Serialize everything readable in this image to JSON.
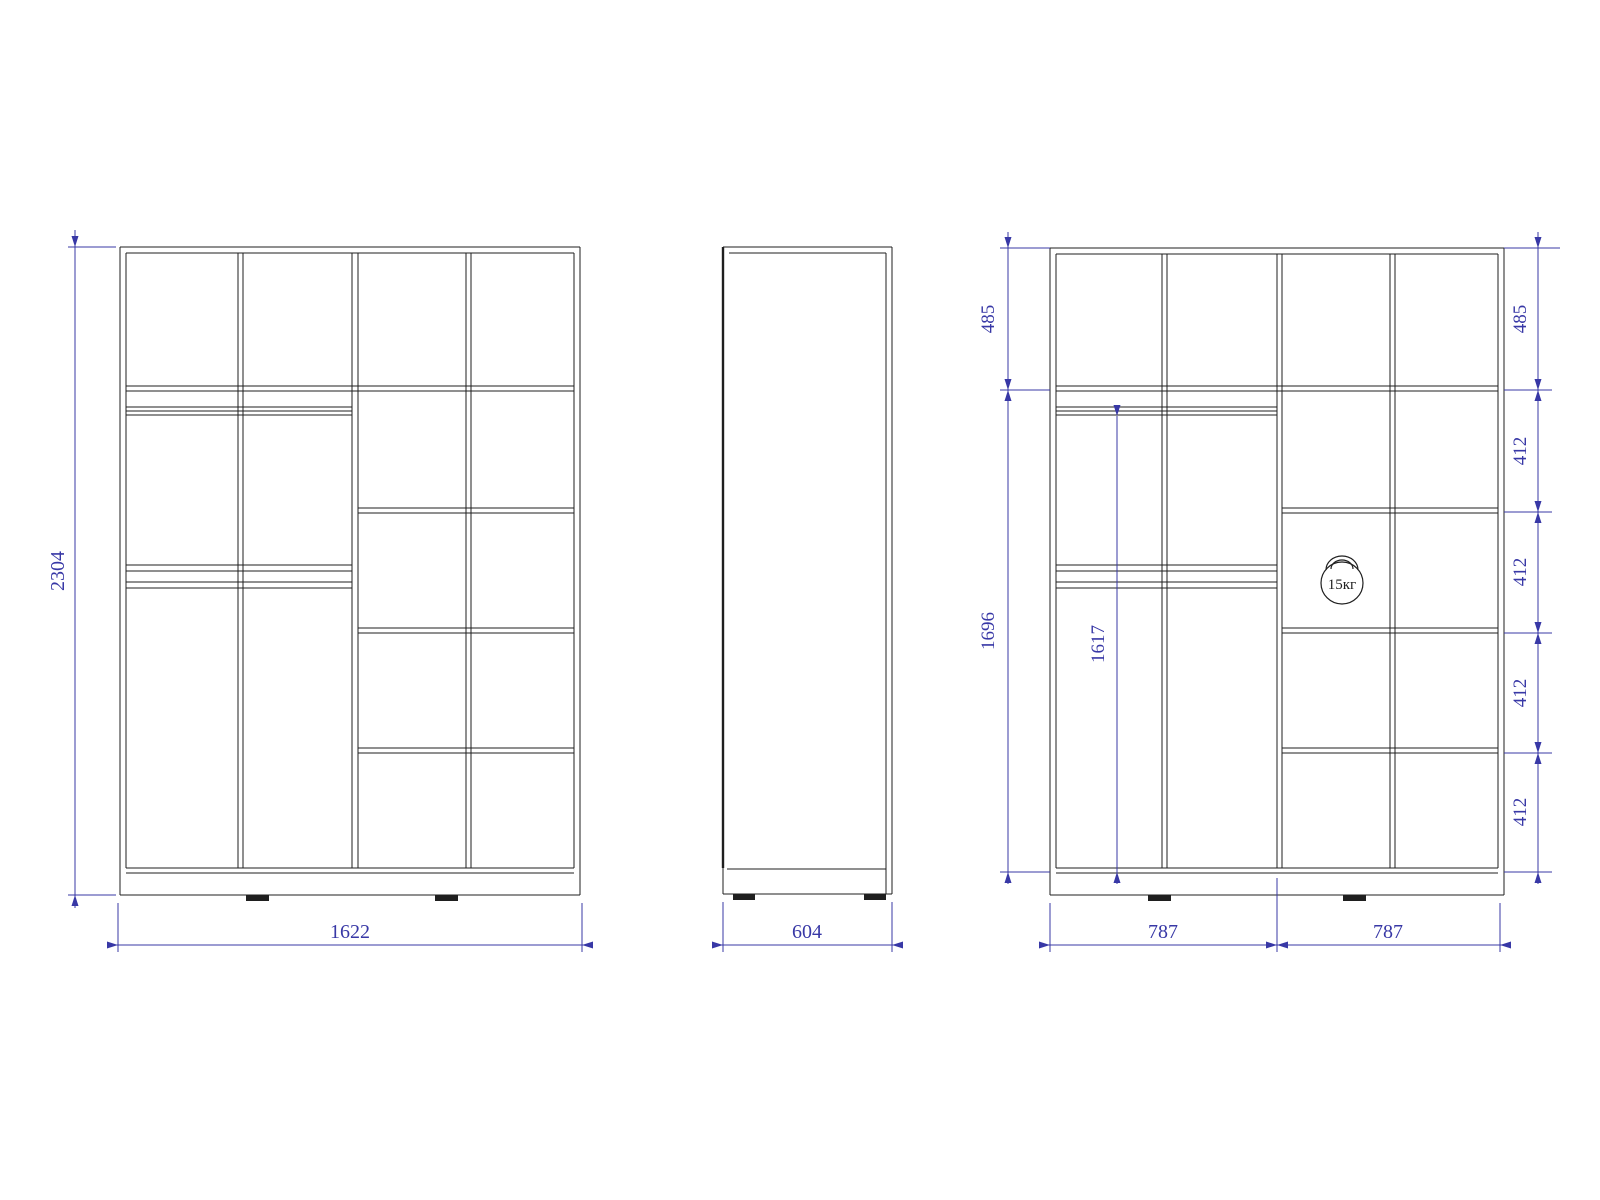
{
  "drawing": {
    "type": "wardrobe-dimension-drawing",
    "background": "#ffffff",
    "line_color": "#1f1f1f",
    "dimension_color": "#3838a6",
    "views": {
      "front": "front-elevation",
      "side": "side-elevation",
      "internal": "internal-elevation-with-dimensions"
    },
    "labels": {
      "overall_height": "2304",
      "overall_width": "1622",
      "depth": "604",
      "left_top_section": "485",
      "left_interior_height": "1696",
      "rod_height": "1617",
      "right_top_section": "485",
      "shelf_spacing_1": "412",
      "shelf_spacing_2": "412",
      "shelf_spacing_3": "412",
      "shelf_spacing_4": "412",
      "half_width_left": "787",
      "half_width_right": "787",
      "shelf_load": "15кг"
    }
  }
}
